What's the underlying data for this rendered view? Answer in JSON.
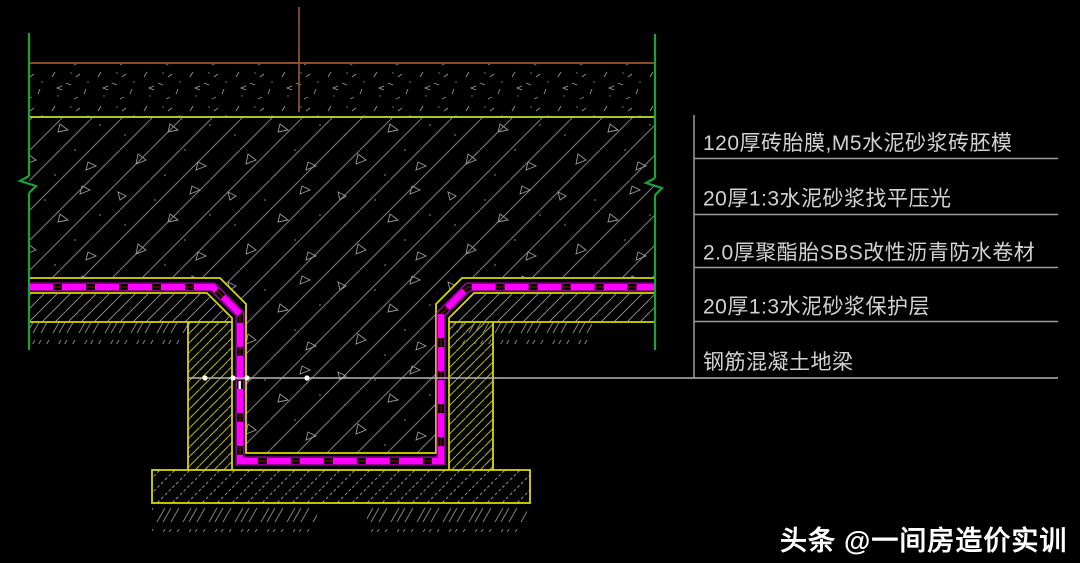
{
  "annotations": {
    "layers": [
      {
        "label": "120厚砖胎膜,M5水泥砂浆砖胚模"
      },
      {
        "label": "20厚1:3水泥砂浆找平压光"
      },
      {
        "label": "2.0厚聚酯胎SBS改性沥青防水卷材"
      },
      {
        "label": "20厚1:3水泥砂浆保护层"
      },
      {
        "label": "钢筋混凝土地梁"
      }
    ]
  },
  "watermark": {
    "brand": "头条",
    "handle": "@一间房造价实训"
  },
  "colors": {
    "background": "#000000",
    "membrane_magenta": "#ff00ff",
    "membrane_core_dark_red": "#7a0a0a",
    "line_yellow": "#d8d800",
    "line_yellow_green": "#a8c820",
    "line_green": "#18a23c",
    "line_brown": "#8a4a28",
    "hatch_gray": "#848484",
    "annotation_line_gray": "#9a9a9a",
    "label_text": "#d2d2d2",
    "centerline_gray": "#b5b5b5",
    "watermark_white": "#ffffff"
  }
}
